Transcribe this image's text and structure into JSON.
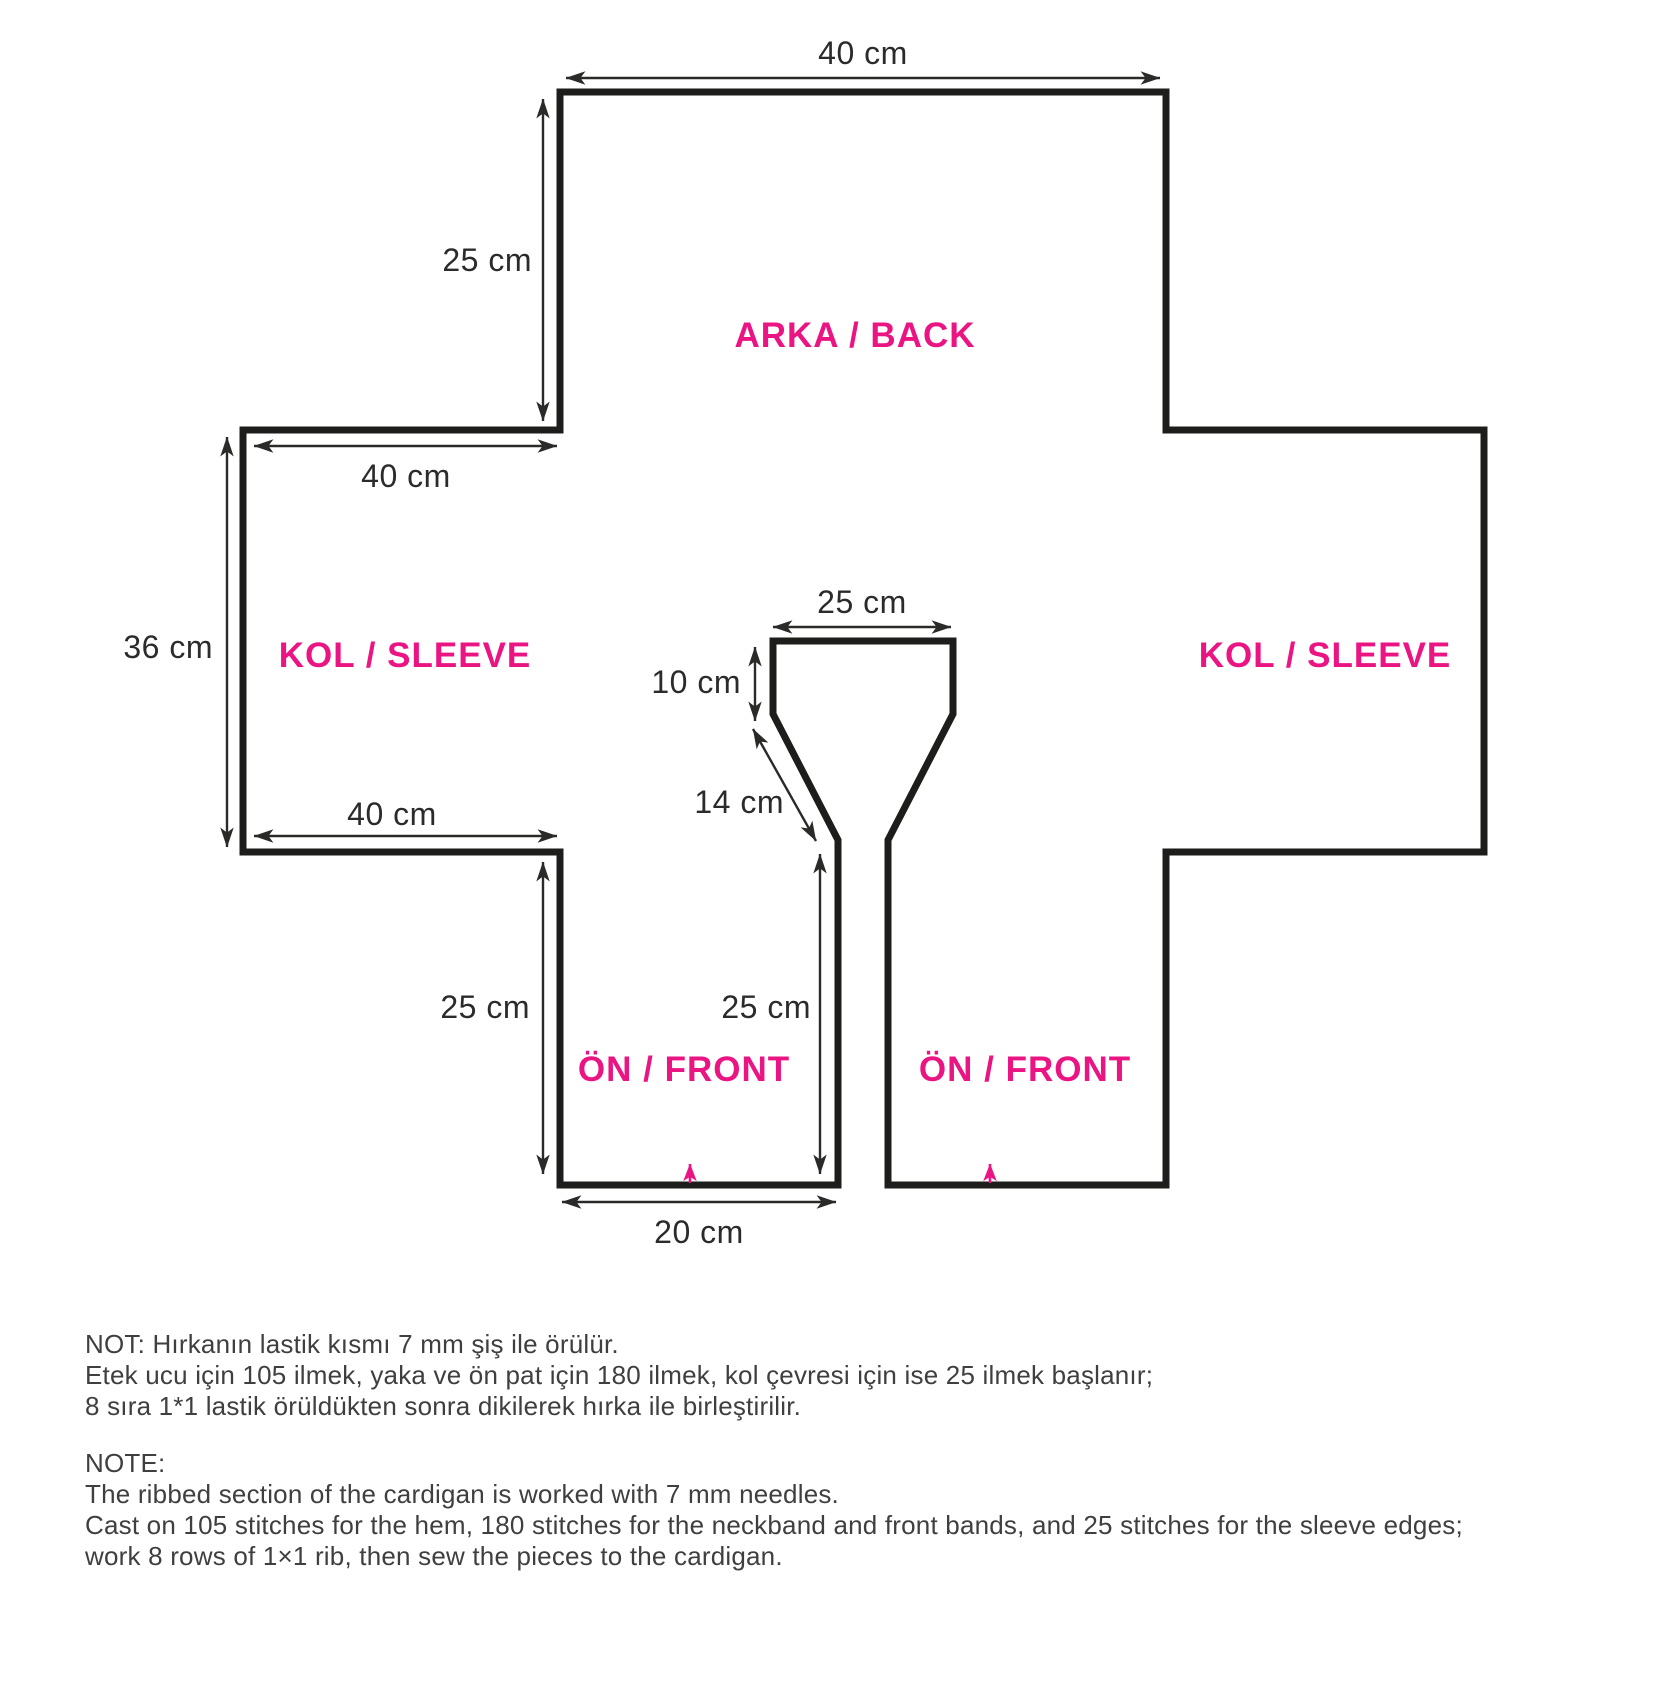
{
  "diagram": {
    "piece_labels": {
      "back": "ARKA / BACK",
      "sleeve_left": "KOL / SLEEVE",
      "sleeve_right": "KOL / SLEEVE",
      "front_left": "ÖN / FRONT",
      "front_right": "ÖN / FRONT"
    },
    "dimensions": {
      "back_width": "40 cm",
      "back_height": "25 cm",
      "sleeve_top_width": "40 cm",
      "sleeve_height": "36 cm",
      "sleeve_bottom_width": "40 cm",
      "neck_width": "25 cm",
      "neck_drop": "10 cm",
      "neck_slant": "14 cm",
      "front_side_height": "25 cm",
      "front_center_height": "25 cm",
      "front_hem_width": "20 cm"
    },
    "colors": {
      "accent_pink": "#EA1483",
      "outline_black": "#1D1D1B",
      "dimension_text": "#2B2B2B",
      "note_text": "#3F3F3F"
    }
  },
  "notes": {
    "tr": [
      "NOT: Hırkanın lastik kısmı 7 mm şiş ile örülür.",
      "Etek ucu için 105 ilmek, yaka ve ön pat için 180 ilmek, kol çevresi için ise 25 ilmek başlanır;",
      "8 sıra 1*1 lastik örüldükten sonra dikilerek hırka ile birleştirilir."
    ],
    "en": [
      "NOTE:",
      "The ribbed section of the cardigan is worked with 7 mm needles.",
      "Cast on 105 stitches for the hem, 180 stitches for the neckband and front bands, and 25 stitches for the sleeve edges;",
      "work 8 rows of 1×1 rib, then sew the pieces to the cardigan."
    ]
  }
}
